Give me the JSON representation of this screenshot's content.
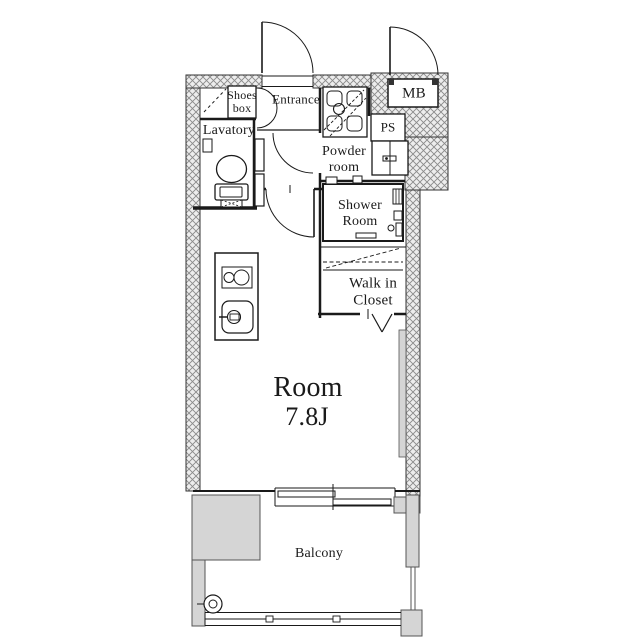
{
  "floorplan": {
    "labels": {
      "shoes_box_line1": "Shoes",
      "shoes_box_line2": "box",
      "entrance": "Entrance",
      "lavatory": "Lavatory",
      "meter_box": "MB",
      "pipe_space": "PS",
      "powder_room_line1": "Powder",
      "powder_room_line2": "room",
      "shower_room_line1": "Shower",
      "shower_room_line2": "Room",
      "walk_in_closet_line1": "Walk in",
      "walk_in_closet_line2": "Closet",
      "main_room_name": "Room",
      "main_room_size": "7.8J",
      "balcony": "Balcony"
    },
    "colors": {
      "background": "#ffffff",
      "line": "#1a1a1a",
      "wall_hatch_bg": "#ededed",
      "wall_hatch_line": "#8a8a8a",
      "balcony_wall_fill": "#d5d5d5",
      "text": "#1a1a1a"
    }
  }
}
